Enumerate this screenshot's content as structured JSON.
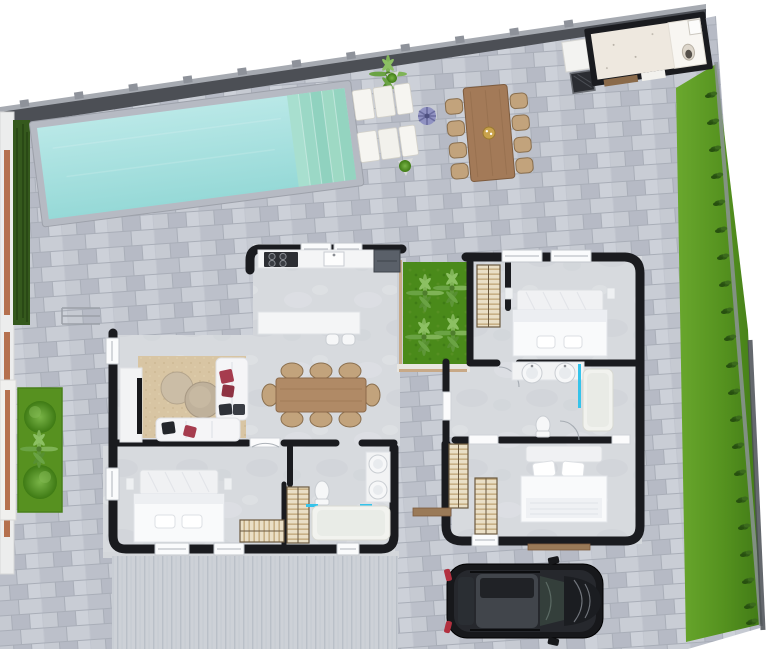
{
  "scene": {
    "type": "floor-plan-3d-render",
    "label": "Aerial 3D floor plan of a single-storey villa with pool, patio, courtyard garden, lawn and driveway",
    "canvas": {
      "width": 768,
      "height": 649
    }
  },
  "palette": {
    "bg": "#ffffff",
    "wall": "#1a1b1f",
    "boundary": "#4c4f55",
    "boundary-cap": "#a6aab1",
    "pool": "#a7dfdf",
    "lawn": "#5d9a25",
    "courtyard-grass": "#4a8a1a",
    "hedge": "#35591d",
    "terracotta": "#b5714f",
    "wood": "#a37a58",
    "wood-dark": "#7d5b3e",
    "chair": "#c2a37c",
    "rug": "#d8c5a3",
    "sofa": "#f5f5f7",
    "accent-red": "#a63c4e",
    "closet": "#eadfc6",
    "closet-line": "#b49a6e",
    "fixture": "#f6f7f8",
    "glass-blue": "#35c3ea",
    "car-body": "#17181b",
    "car-roof": "#41454b",
    "concrete": "#d7dade"
  },
  "areas": [
    {
      "name": "boundary-wall",
      "label": "Perimeter wall"
    },
    {
      "name": "patio",
      "label": "Paved patio"
    },
    {
      "name": "swimming-pool",
      "label": "Swimming pool with steps"
    },
    {
      "name": "sun-loungers",
      "label": "Sun loungers"
    },
    {
      "name": "outdoor-dining",
      "label": "Outdoor dining set for 8"
    },
    {
      "name": "outbuilding",
      "label": "Outdoor kitchen / storage building"
    },
    {
      "name": "lawn",
      "label": "Side lawn"
    },
    {
      "name": "hedge",
      "label": "Boundary hedge"
    },
    {
      "name": "side-garden",
      "label": "Side garden with bushes"
    },
    {
      "name": "kitchen",
      "label": "Kitchen with island"
    },
    {
      "name": "living-room",
      "label": "Living room"
    },
    {
      "name": "dining-room",
      "label": "Indoor dining for 8"
    },
    {
      "name": "courtyard-garden",
      "label": "Interior courtyard garden"
    },
    {
      "name": "bedroom-1",
      "label": "Bedroom top right"
    },
    {
      "name": "ensuite-bathroom",
      "label": "En-suite bathroom"
    },
    {
      "name": "bedroom-2",
      "label": "Bedroom bottom right"
    },
    {
      "name": "master-bedroom",
      "label": "Bedroom bottom left"
    },
    {
      "name": "main-bathroom",
      "label": "Main bathroom"
    },
    {
      "name": "driveway",
      "label": "Driveway"
    },
    {
      "name": "car",
      "label": "Parked black SUV"
    },
    {
      "name": "entry-steps",
      "label": "Entry steps"
    }
  ],
  "counts": {
    "bedrooms": 3,
    "bathrooms": 2,
    "outdoor_dining_seats": 8,
    "indoor_dining_seats": 8,
    "sun_loungers": 2,
    "pool_steps": 5,
    "island_stools": 2,
    "wardrobes": 5,
    "garden_bushes": 2,
    "courtyard_plants": 4,
    "cars": 1
  }
}
